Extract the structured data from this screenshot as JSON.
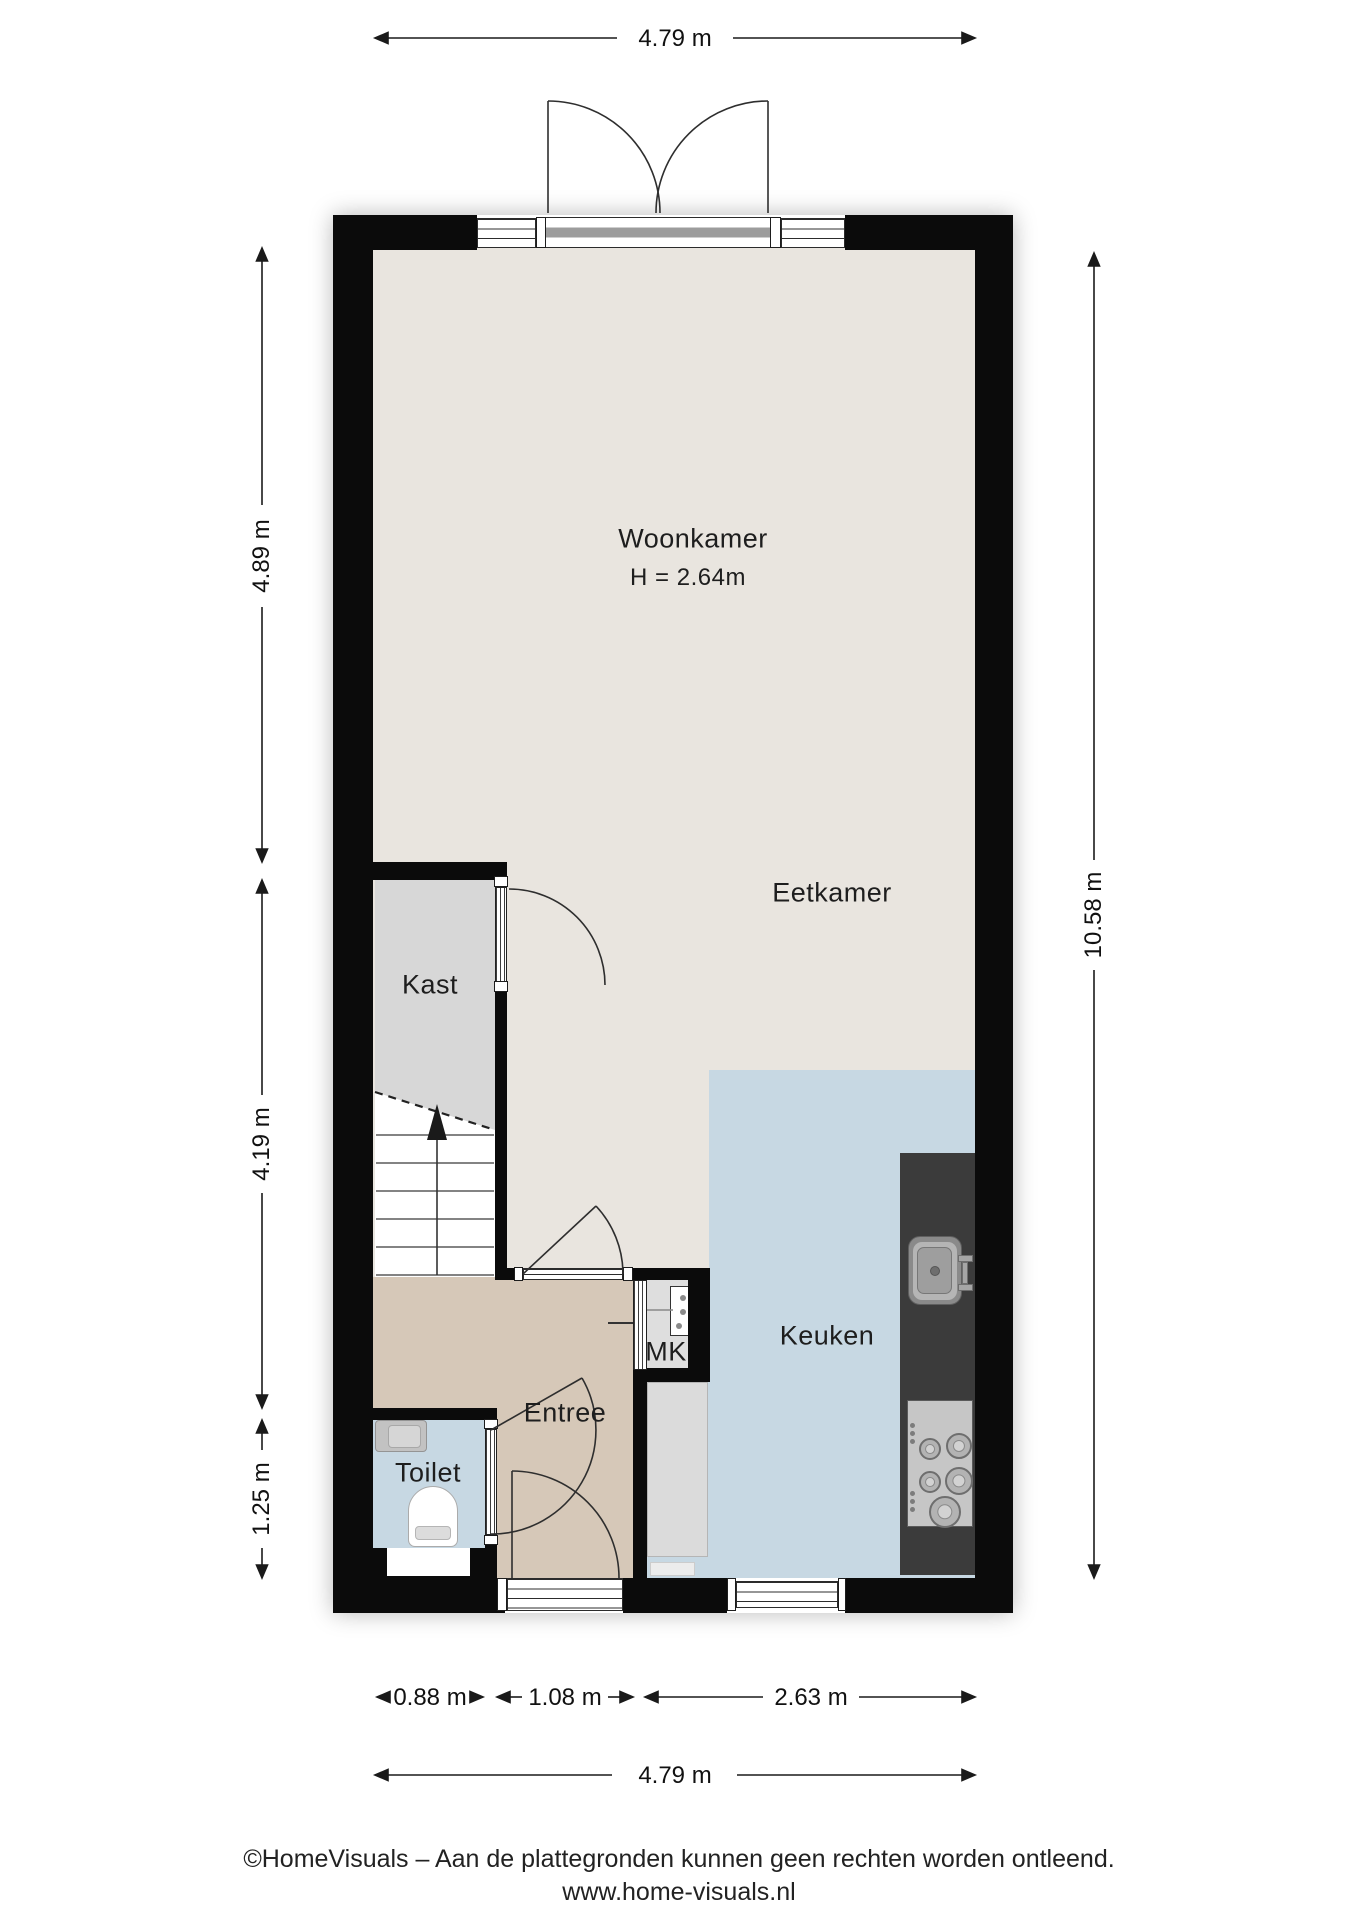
{
  "floorplan": {
    "rooms": {
      "woonkamer": {
        "label": "Woonkamer",
        "height_note": "H = 2.64m"
      },
      "eetkamer": {
        "label": "Eetkamer"
      },
      "kast": {
        "label": "Kast"
      },
      "keuken": {
        "label": "Keuken"
      },
      "entree": {
        "label": "Entree"
      },
      "toilet": {
        "label": "Toilet"
      },
      "meterkast": {
        "label": "MK"
      }
    },
    "dimensions": {
      "top_width": "4.79 m",
      "left_upper": "4.89 m",
      "left_middle": "4.19 m",
      "left_lower": "1.25 m",
      "right_height": "10.58 m",
      "bottom_toilet": "0.88 m",
      "bottom_entree": "1.08 m",
      "bottom_keuken": "2.63 m",
      "bottom_total": "4.79 m"
    }
  },
  "footer": {
    "line1": "©HomeVisuals – Aan de plattegronden kunnen geen rechten worden ontleend.",
    "line2": "www.home-visuals.nl"
  },
  "colors": {
    "floor-beige": "#e9e5df",
    "floor-gray": "#d7d7d7",
    "floor-tan": "#d6c8b8",
    "floor-blue": "#c7d8e3",
    "wall": "#0b0b0b",
    "counter-dark": "#3b3b3b",
    "cabinet-gray": "#dbdbdb",
    "appliance-gray": "#c6c6c6",
    "line": "#1a1a1a"
  }
}
